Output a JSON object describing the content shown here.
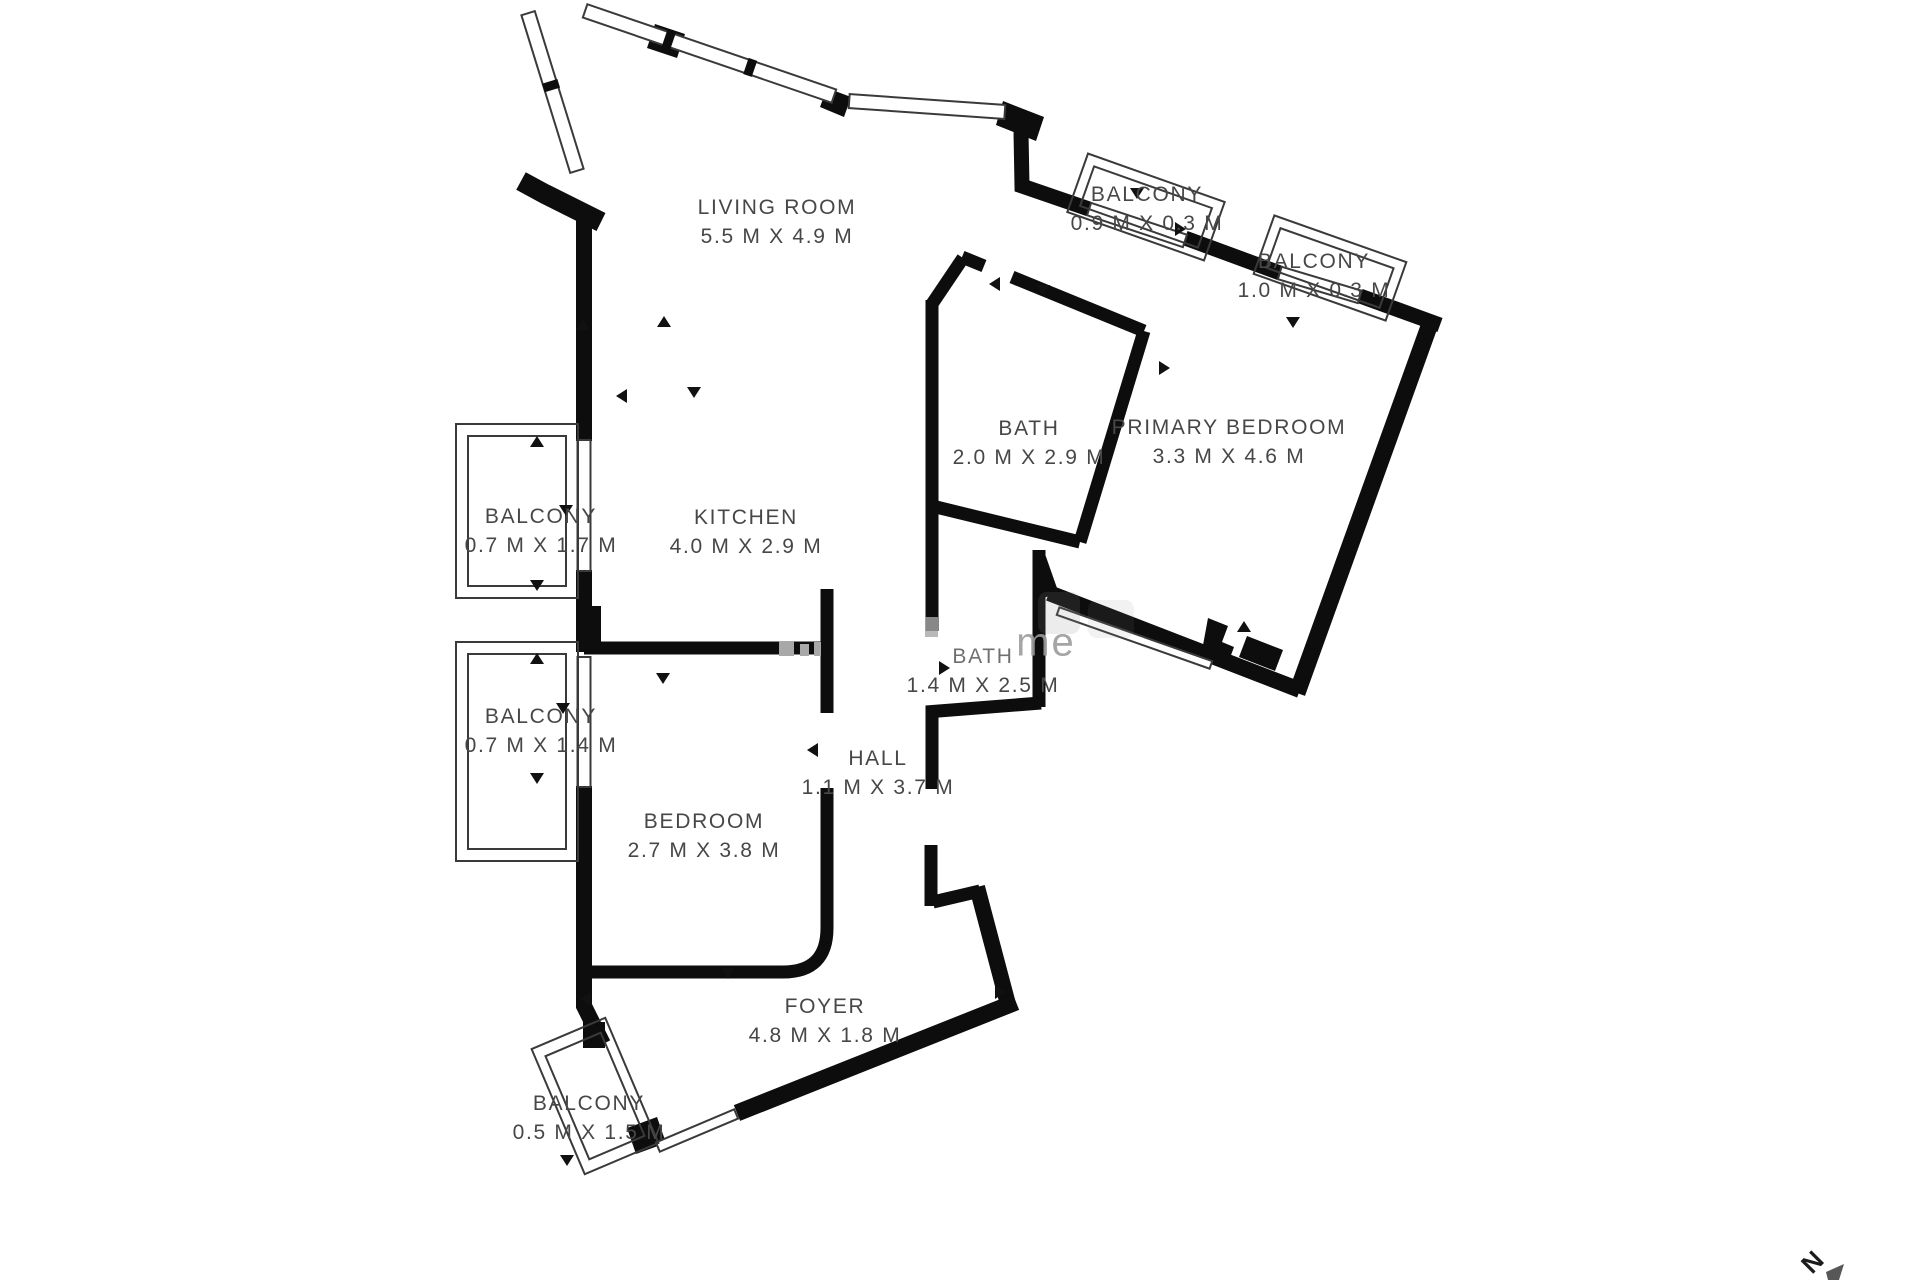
{
  "plan": {
    "type": "floor-plan",
    "units": "M",
    "rooms": [
      {
        "id": "living-room",
        "name": "LIVING ROOM",
        "dims": "5.5 M X 4.9 M"
      },
      {
        "id": "balcony-top-1",
        "name": "BALCONY",
        "dims": "0.9 M X 0.3 M"
      },
      {
        "id": "balcony-top-2",
        "name": "BALCONY",
        "dims": "1.0 M X 0.3 M"
      },
      {
        "id": "bath-1",
        "name": "BATH",
        "dims": "2.0 M X 2.9 M"
      },
      {
        "id": "primary-bedroom",
        "name": "PRIMARY BEDROOM",
        "dims": "3.3 M X 4.6 M"
      },
      {
        "id": "balcony-left-1",
        "name": "BALCONY",
        "dims": "0.7 M X 1.7 M"
      },
      {
        "id": "kitchen",
        "name": "KITCHEN",
        "dims": "4.0 M X 2.9 M"
      },
      {
        "id": "balcony-left-2",
        "name": "BALCONY",
        "dims": "0.7 M X 1.4 M"
      },
      {
        "id": "bath-2",
        "name": "BATH",
        "dims": "1.4 M X 2.5 M"
      },
      {
        "id": "hall",
        "name": "HALL",
        "dims": "1.1 M X 3.7 M"
      },
      {
        "id": "bedroom",
        "name": "BEDROOM",
        "dims": "2.7 M X 3.8 M"
      },
      {
        "id": "foyer",
        "name": "FOYER",
        "dims": "4.8 M X 1.8 M"
      },
      {
        "id": "balcony-bottom",
        "name": "BALCONY",
        "dims": "0.5 M X 1.5 M"
      }
    ],
    "compass": {
      "label": "N"
    },
    "watermark": {
      "text": "me"
    },
    "colors": {
      "background": "#ffffff",
      "wall": "#0d0d0d",
      "thin_line": "#3a3a3a",
      "label_text": "#474747",
      "watermark": "#9c9c9c"
    }
  }
}
